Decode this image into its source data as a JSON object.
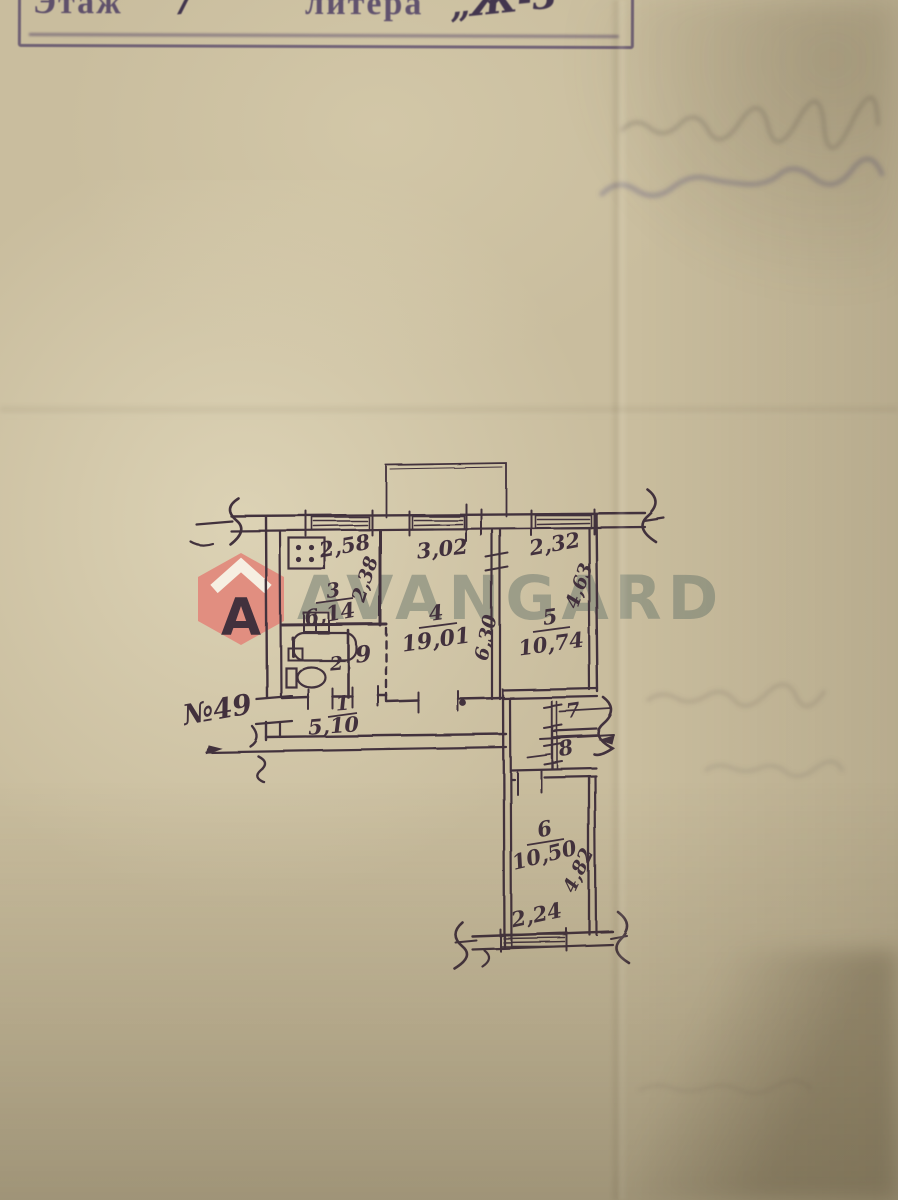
{
  "stamp": {
    "floor_label": "Этаж",
    "floor_value": "7",
    "litera_label": "литера",
    "litera_value": "„Ж-3"
  },
  "watermark": {
    "brand": "AVANGARD",
    "logo_letter": "A"
  },
  "plan": {
    "apartment_number": "№49",
    "rooms": [
      {
        "number": "1",
        "area": "5,10"
      },
      {
        "number": "2",
        "area": ""
      },
      {
        "number": "3",
        "area": "6,14"
      },
      {
        "number": "4",
        "area": "19,01"
      },
      {
        "number": "5",
        "area": "10,74"
      },
      {
        "number": "6",
        "area": "10,50"
      },
      {
        "number": "7",
        "area": ""
      },
      {
        "number": "8",
        "area": ""
      },
      {
        "number": "9",
        "area": ""
      }
    ],
    "dimensions": {
      "kitchen_width": "2,58",
      "room4_width": "3,02",
      "room5_width": "2,32",
      "kitchen_depth": "2,38",
      "room4_depth": "6,30",
      "room5_depth": "4,63",
      "room6_depth": "4,82",
      "room6_width": "2,24"
    }
  },
  "colors": {
    "paper": "#c9bd9e",
    "ink": "#42313d",
    "stamp_purple": "#6a5ca4",
    "watermark_gray": "#7c8477",
    "logo_coral": "#e2897c"
  }
}
